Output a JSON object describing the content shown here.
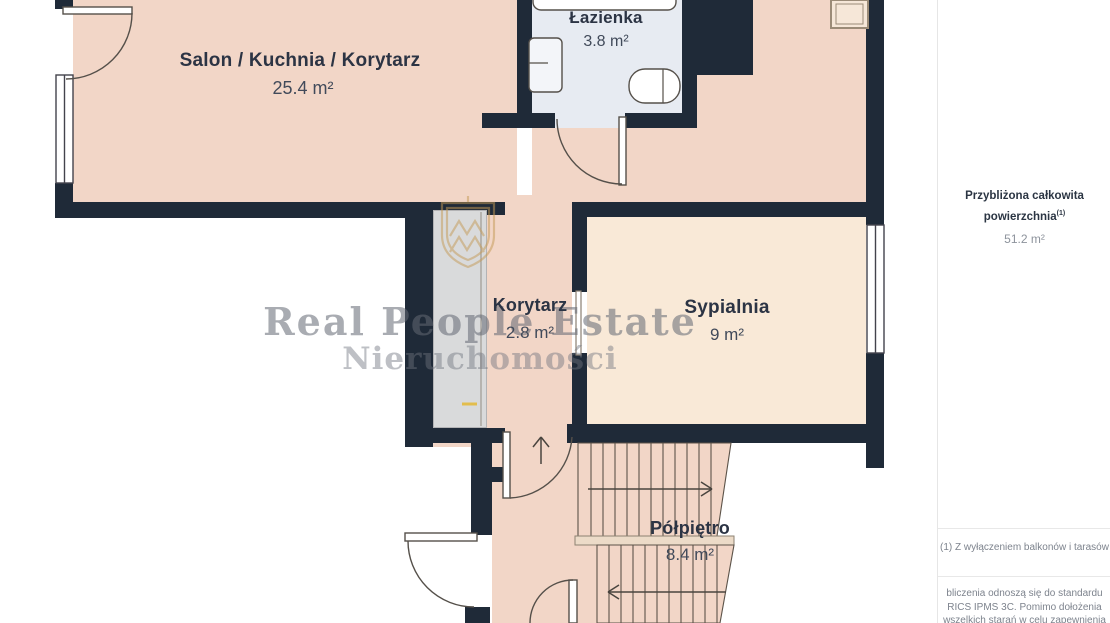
{
  "rooms": {
    "salon": {
      "name": "Salon / Kuchnia / Korytarz",
      "area": "25.4 m²"
    },
    "lazienka": {
      "name": "Łazienka",
      "area": "3.8 m²"
    },
    "korytarz": {
      "name": "Korytarz",
      "area": "2.8 m²"
    },
    "sypialnia": {
      "name": "Sypialnia",
      "area": "9 m²"
    },
    "polpietro": {
      "name": "Półpiętro",
      "area": "8.4 m²"
    }
  },
  "watermark": {
    "line1": "Real People Estate",
    "line2": "Nieruchomości"
  },
  "sidebar": {
    "total_label_line1": "Przybliżona całkowita",
    "total_label_line2": "powierzchnia",
    "total_sup": "(1)",
    "total_value": "51.2 m²",
    "footnote1": "(1) Z wyłączeniem balkonów i tarasów",
    "footnote2_line1": "bliczenia odnoszą się do standardu",
    "footnote2_line2": "RICS IPMS 3C. Pomimo dołożenia",
    "footnote2_line3": "wszelkich starań w celu zapewnienia"
  },
  "colors": {
    "wall": "#1f2a38",
    "floor_main": "#f2d6c7",
    "floor_bedroom": "#f9e9d7",
    "floor_bathroom": "#e7ebf2",
    "wardrobe": "#d9dadb",
    "logo_gold": "#c49a55"
  }
}
